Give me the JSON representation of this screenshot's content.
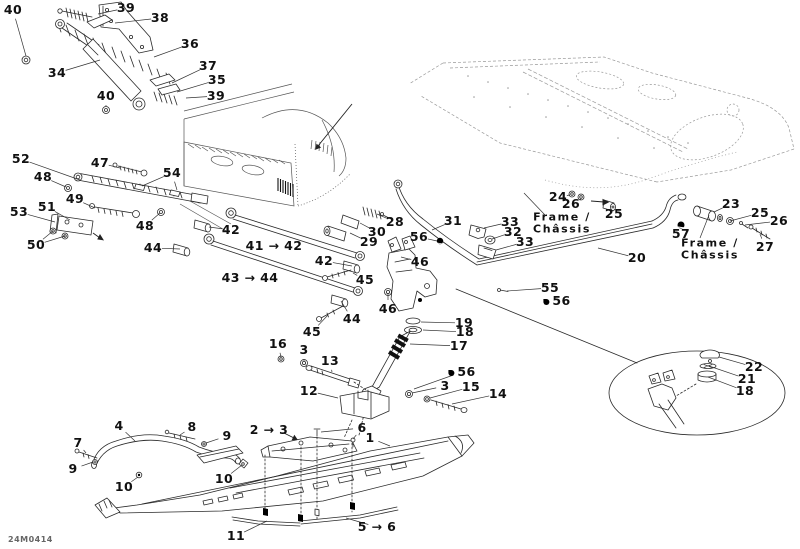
{
  "meta": {
    "part_code": "24M0414",
    "background": "#ffffff",
    "line_color": "#2a2a2a",
    "label_color": "#111111"
  },
  "texts": {
    "frame_label": "Frame /\nChâssis"
  },
  "callouts": [
    {
      "label": "40",
      "x": 13,
      "y": 10,
      "t": [
        [
          26,
          56
        ]
      ]
    },
    {
      "label": "39",
      "x": 126,
      "y": 8,
      "t": [
        [
          98,
          14
        ]
      ]
    },
    {
      "label": "38",
      "x": 160,
      "y": 18,
      "t": [
        [
          115,
          23
        ]
      ]
    },
    {
      "label": "36",
      "x": 190,
      "y": 44,
      "t": [
        [
          154,
          57
        ]
      ]
    },
    {
      "label": "34",
      "x": 57,
      "y": 73,
      "t": [
        [
          100,
          60
        ]
      ]
    },
    {
      "label": "37",
      "x": 208,
      "y": 66,
      "t": [
        [
          172,
          83
        ]
      ]
    },
    {
      "label": "35",
      "x": 217,
      "y": 80,
      "t": [
        [
          177,
          92
        ]
      ]
    },
    {
      "label": "39",
      "x": 216,
      "y": 96,
      "t": [
        [
          186,
          98
        ]
      ]
    },
    {
      "label": "40",
      "x": 106,
      "y": 96,
      "t": [
        [
          106,
          106
        ]
      ]
    },
    {
      "label": "52",
      "x": 21,
      "y": 159,
      "t": [
        [
          80,
          180
        ]
      ]
    },
    {
      "label": "48",
      "x": 43,
      "y": 177,
      "t": [
        [
          66,
          187
        ]
      ]
    },
    {
      "label": "47",
      "x": 100,
      "y": 163,
      "t": [
        [
          120,
          168
        ]
      ]
    },
    {
      "label": "54",
      "x": 172,
      "y": 173,
      "t": [
        [
          142,
          186
        ],
        [
          177,
          190
        ]
      ]
    },
    {
      "label": "49",
      "x": 75,
      "y": 199,
      "t": [
        [
          95,
          208
        ]
      ]
    },
    {
      "label": "53",
      "x": 19,
      "y": 212,
      "t": [
        [
          55,
          222
        ]
      ]
    },
    {
      "label": "51",
      "x": 47,
      "y": 207,
      "t": [
        [
          70,
          220
        ]
      ]
    },
    {
      "label": "48",
      "x": 145,
      "y": 226,
      "t": [
        [
          160,
          213
        ]
      ]
    },
    {
      "label": "50",
      "x": 36,
      "y": 245,
      "t": [
        [
          53,
          231
        ],
        [
          65,
          236
        ]
      ]
    },
    {
      "label": "44",
      "x": 153,
      "y": 248,
      "t": [
        [
          180,
          249
        ]
      ]
    },
    {
      "label": "42",
      "x": 231,
      "y": 230,
      "t": [
        [
          209,
          227
        ]
      ]
    },
    {
      "label": "41 → 42",
      "x": 274,
      "y": 246,
      "t": []
    },
    {
      "label": "43 → 44",
      "x": 250,
      "y": 278,
      "t": []
    },
    {
      "label": "42",
      "x": 324,
      "y": 261,
      "t": [
        [
          352,
          266
        ]
      ]
    },
    {
      "label": "45",
      "x": 365,
      "y": 280,
      "t": [
        [
          353,
          273
        ]
      ]
    },
    {
      "label": "44",
      "x": 352,
      "y": 319,
      "t": [
        [
          341,
          301
        ]
      ]
    },
    {
      "label": "45",
      "x": 312,
      "y": 332,
      "t": [
        [
          328,
          315
        ]
      ]
    },
    {
      "label": "46",
      "x": 420,
      "y": 262,
      "t": [
        [
          401,
          257
        ]
      ]
    },
    {
      "label": "46",
      "x": 388,
      "y": 309,
      "t": [
        [
          388,
          293
        ]
      ]
    },
    {
      "label": "28",
      "x": 395,
      "y": 222,
      "t": [
        [
          377,
          214
        ]
      ]
    },
    {
      "label": "30",
      "x": 377,
      "y": 232,
      "t": [
        [
          360,
          223
        ]
      ]
    },
    {
      "label": "29",
      "x": 369,
      "y": 242,
      "t": [
        [
          350,
          233
        ]
      ]
    },
    {
      "label": "56",
      "x": 419,
      "y": 237,
      "t": [
        [
          437,
          241
        ]
      ]
    },
    {
      "label": "31",
      "x": 453,
      "y": 221,
      "t": [
        [
          432,
          230
        ]
      ]
    },
    {
      "label": "33",
      "x": 510,
      "y": 222,
      "t": [
        [
          484,
          228
        ]
      ]
    },
    {
      "label": "32",
      "x": 513,
      "y": 232,
      "t": [
        [
          492,
          239
        ]
      ]
    },
    {
      "label": "33",
      "x": 525,
      "y": 242,
      "t": [
        [
          496,
          250
        ]
      ]
    },
    {
      "label": "24",
      "x": 558,
      "y": 197,
      "t": [
        [
          570,
          195
        ]
      ]
    },
    {
      "label": "26",
      "x": 571,
      "y": 204,
      "t": [
        [
          581,
          199
        ]
      ]
    },
    {
      "label": "25",
      "x": 614,
      "y": 214,
      "t": [
        [
          611,
          207
        ]
      ]
    },
    {
      "label": "Frame /\nChâssis",
      "x": 562,
      "y": 224,
      "cls": "frame",
      "f": [
        545,
        215
      ],
      "t": [
        [
          524,
          193
        ]
      ]
    },
    {
      "label": "23",
      "x": 731,
      "y": 204,
      "t": [
        [
          714,
          212
        ]
      ]
    },
    {
      "label": "25",
      "x": 760,
      "y": 213,
      "t": [
        [
          730,
          221
        ]
      ]
    },
    {
      "label": "26",
      "x": 779,
      "y": 221,
      "t": [
        [
          745,
          225
        ]
      ]
    },
    {
      "label": "27",
      "x": 765,
      "y": 247,
      "t": [
        [
          760,
          234
        ]
      ]
    },
    {
      "label": "57",
      "x": 681,
      "y": 234,
      "t": []
    },
    {
      "label": "Frame /\nChâssis",
      "x": 710,
      "y": 250,
      "cls": "frame",
      "f": [
        700,
        238
      ],
      "t": [
        [
          709,
          215
        ]
      ]
    },
    {
      "label": "20",
      "x": 637,
      "y": 258,
      "t": [
        [
          598,
          248
        ]
      ]
    },
    {
      "label": "55",
      "x": 550,
      "y": 288,
      "t": [
        [
          507,
          291
        ]
      ]
    },
    {
      "label": "56",
      "x": 557,
      "y": 301,
      "drop": true,
      "t": []
    },
    {
      "label": "19",
      "x": 464,
      "y": 323,
      "t": [
        [
          421,
          322
        ]
      ]
    },
    {
      "label": "18",
      "x": 465,
      "y": 332,
      "t": [
        [
          423,
          330
        ]
      ]
    },
    {
      "label": "17",
      "x": 459,
      "y": 346,
      "t": [
        [
          410,
          344
        ]
      ]
    },
    {
      "label": "16",
      "x": 278,
      "y": 344,
      "t": [
        [
          281,
          357
        ]
      ]
    },
    {
      "label": "3",
      "x": 304,
      "y": 350,
      "t": [
        [
          304,
          361
        ]
      ]
    },
    {
      "label": "13",
      "x": 330,
      "y": 361,
      "t": [
        [
          332,
          372
        ]
      ]
    },
    {
      "label": "12",
      "x": 309,
      "y": 391,
      "t": [
        [
          338,
          398
        ]
      ]
    },
    {
      "label": "56",
      "x": 462,
      "y": 372,
      "drop": true,
      "t": [
        [
          414,
          389
        ]
      ]
    },
    {
      "label": "3",
      "x": 445,
      "y": 386,
      "t": [
        [
          412,
          393
        ]
      ]
    },
    {
      "label": "15",
      "x": 471,
      "y": 387,
      "t": [
        [
          430,
          398
        ]
      ]
    },
    {
      "label": "14",
      "x": 498,
      "y": 394,
      "t": [
        [
          452,
          404
        ]
      ]
    },
    {
      "label": "4",
      "x": 119,
      "y": 426,
      "t": [
        [
          135,
          441
        ]
      ]
    },
    {
      "label": "8",
      "x": 192,
      "y": 427,
      "t": [
        [
          180,
          435
        ]
      ]
    },
    {
      "label": "9",
      "x": 227,
      "y": 436,
      "t": [
        [
          206,
          443
        ]
      ]
    },
    {
      "label": "7",
      "x": 78,
      "y": 443,
      "t": [
        [
          86,
          453
        ]
      ]
    },
    {
      "label": "9",
      "x": 73,
      "y": 469,
      "t": [
        [
          93,
          462
        ]
      ]
    },
    {
      "label": "10",
      "x": 124,
      "y": 487,
      "t": [
        [
          138,
          477
        ]
      ]
    },
    {
      "label": "10",
      "x": 224,
      "y": 479,
      "t": [
        [
          242,
          465
        ]
      ]
    },
    {
      "label": "2 → 3",
      "x": 269,
      "y": 430,
      "t": []
    },
    {
      "label": "6",
      "x": 362,
      "y": 428,
      "t": [
        [
          321,
          432
        ],
        [
          353,
          439
        ]
      ]
    },
    {
      "label": "1",
      "x": 370,
      "y": 438,
      "t": [
        [
          390,
          446
        ]
      ]
    },
    {
      "label": "5 → 6",
      "x": 377,
      "y": 527,
      "t": [
        [
          346,
          518
        ]
      ]
    },
    {
      "label": "11",
      "x": 236,
      "y": 536,
      "t": [
        [
          267,
          521
        ]
      ]
    },
    {
      "label": "22",
      "x": 754,
      "y": 367,
      "t": [
        [
          719,
          357
        ]
      ]
    },
    {
      "label": "21",
      "x": 747,
      "y": 379,
      "t": [
        [
          709,
          366
        ]
      ]
    },
    {
      "label": "18",
      "x": 745,
      "y": 391,
      "t": [
        [
          708,
          377
        ]
      ]
    }
  ]
}
